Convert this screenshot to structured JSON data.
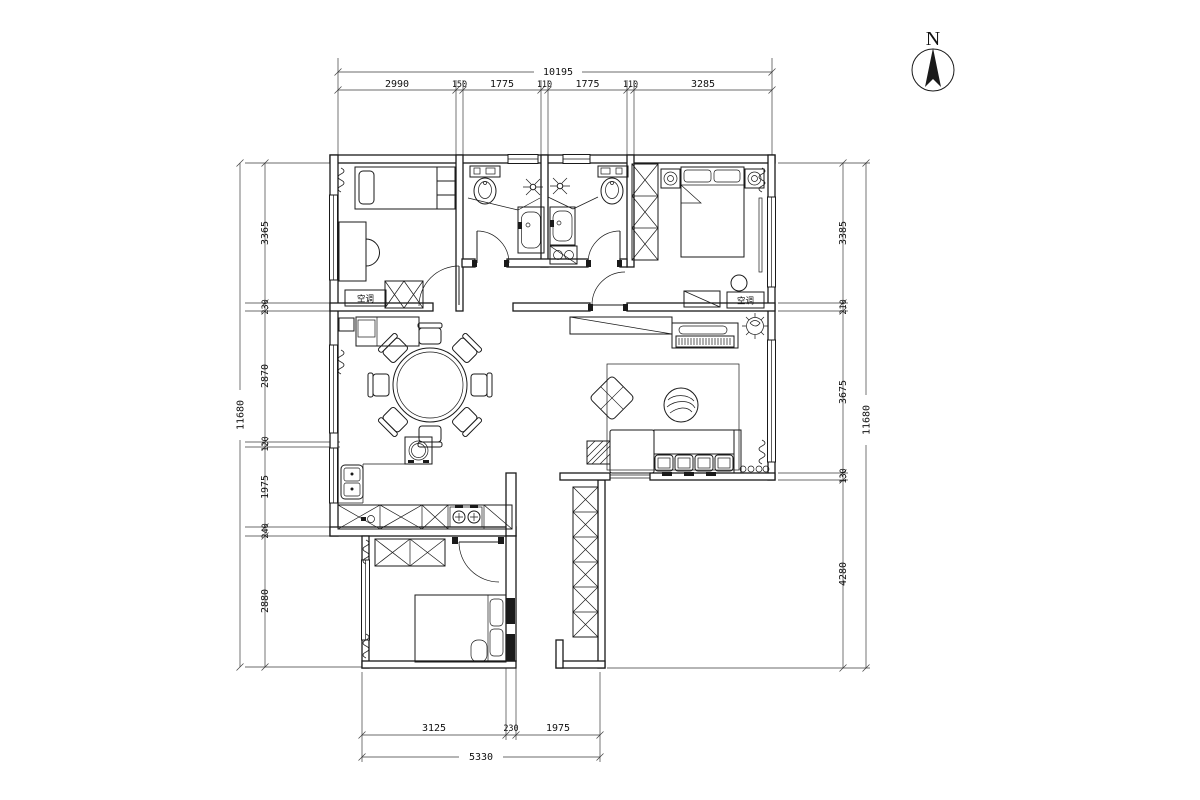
{
  "compass": {
    "label": "N"
  },
  "labels": {
    "ac": "空调"
  },
  "dims": {
    "top": {
      "overall": "10195",
      "s": [
        "2990",
        "150",
        "1775",
        "110",
        "1775",
        "110",
        "3285"
      ]
    },
    "left": {
      "overall": "11680",
      "s": [
        "3365",
        "230",
        "2870",
        "120",
        "1975",
        "240",
        "2880"
      ]
    },
    "right": {
      "overall": "11680",
      "s": [
        "3385",
        "210",
        "3675",
        "130",
        "4280"
      ]
    },
    "bottom": {
      "overall": "5330",
      "s": [
        "3125",
        "230",
        "1975"
      ]
    }
  },
  "colors": {
    "line": "#1a1a1a",
    "background": "#ffffff"
  }
}
